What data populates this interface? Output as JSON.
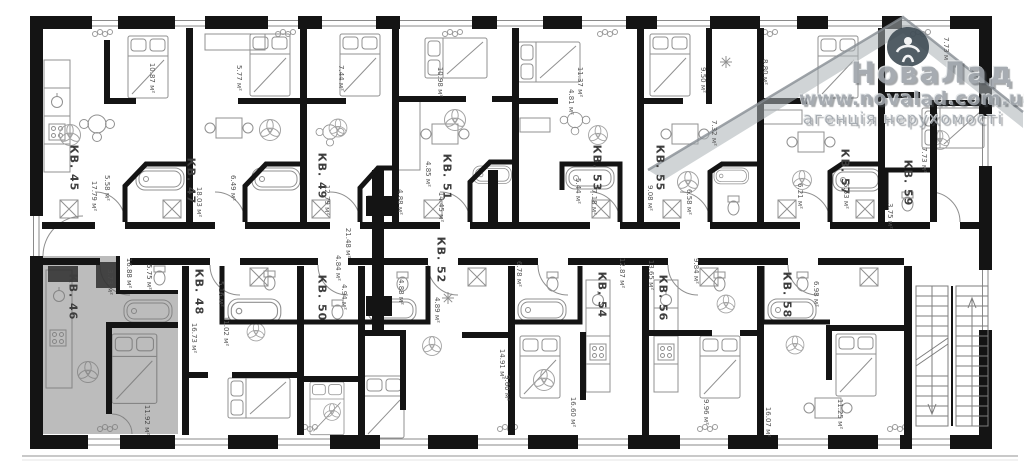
{
  "document": {
    "kind": "apartment floor plan"
  },
  "watermark": {
    "brand": "НоваЛад",
    "url": "www.novalad.com.ua",
    "tagline": "агенція нерухомості",
    "color": "#9ea4aa"
  },
  "highlight": {
    "unit": "КВ. 46",
    "color": "#7a7a7a"
  },
  "corridor": {
    "area": "21.48 м²"
  },
  "units": [
    {
      "label": "КВ. 45",
      "areas": [
        "10.87 м²",
        "17.79 м²",
        "5.58 м²"
      ]
    },
    {
      "label": "КВ. 47",
      "areas": [
        "5.77 м²",
        "18.03 м²",
        "6.49 м²"
      ]
    },
    {
      "label": "КВ. 49",
      "areas": [
        "7.44 м²",
        "12.79 м²"
      ]
    },
    {
      "label": "КВ. 51",
      "areas": [
        "10.98 м²",
        "4.85 м²",
        "14.45 м²",
        "4.88 м²"
      ]
    },
    {
      "label": "КВ. 53",
      "areas": [
        "11.37 м²",
        "4.81 м²",
        "5.44 м²",
        "7.18 м²"
      ]
    },
    {
      "label": "КВ. 55",
      "areas": [
        "9.50 м²",
        "7.32 м²",
        "9.08 м²",
        "6.58 м²"
      ]
    },
    {
      "label": "КВ. 57",
      "areas": [
        "8.80 м²",
        "6.21 м²",
        "5.53 м²"
      ]
    },
    {
      "label": "КВ. 59",
      "areas": [
        "7.73 м²",
        "7.73 м²",
        "3.75 м²"
      ]
    },
    {
      "label": "КВ. 46",
      "areas": [
        "16.88 м²",
        "5.75 м²",
        "3.73 м²",
        "11.92 м²"
      ]
    },
    {
      "label": "КВ. 48",
      "areas": [
        "5.16 м²",
        "11.02 м²",
        "16.73 м²"
      ]
    },
    {
      "label": "КВ. 50",
      "areas": [
        "4.84 м²",
        "4.94 м²"
      ]
    },
    {
      "label": "КВ. 52",
      "areas": [
        "4.89 м²",
        "4.88 м²"
      ]
    },
    {
      "label": "КВ. 54",
      "areas": [
        "6.78 м²",
        "12.87 м²",
        "14.91 м²",
        "9.60 м²",
        "16.60 м²"
      ]
    },
    {
      "label": "КВ. 56",
      "areas": [
        "13.65 м²",
        "9.84 м²",
        "9.96 м²"
      ]
    },
    {
      "label": "КВ. 58",
      "areas": [
        "6.98 м²",
        "16.07 м²",
        "11.25 м²"
      ]
    }
  ]
}
